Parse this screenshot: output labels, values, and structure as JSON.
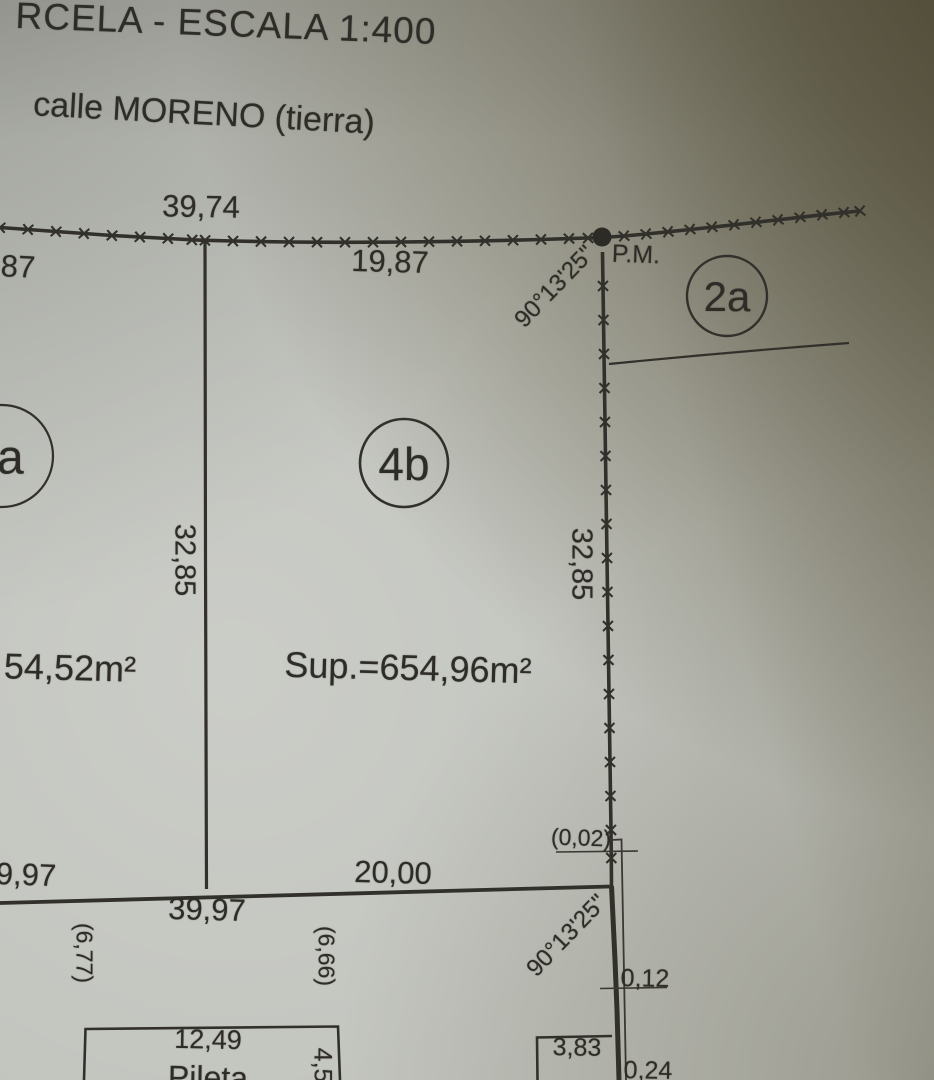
{
  "page": {
    "title_partial": "RCELA - ESCALA 1:400",
    "street_label": "calle MORENO (tierra)"
  },
  "parcels": {
    "center": {
      "id": "4b",
      "area": "Sup.=654,96m²"
    },
    "left": {
      "id": "4a",
      "area_partial": "54,52m²"
    },
    "right": {
      "id": "2a"
    }
  },
  "survey_marks": {
    "pm_label": "P.M.",
    "angle_top": "90°13'25\"",
    "angle_bottom": "90°13'25\""
  },
  "dims": {
    "top_total": "39,74",
    "top_left_partial": "87",
    "top_right_segment": "19,87",
    "left_side": "32,85",
    "right_side": "32,85",
    "bottom_left_partial": "9,97",
    "bottom_segment": "20,00",
    "bottom_total": "39,97",
    "offset_gap": "(0,02)",
    "offset_left": "(6,77)",
    "offset_center": "(6,66)",
    "small_right_1": "0,12",
    "small_right_2": "3,83",
    "small_right_3": "0,24"
  },
  "pool": {
    "label": "Pileta",
    "width": "12,49",
    "depth": "4,50"
  }
}
